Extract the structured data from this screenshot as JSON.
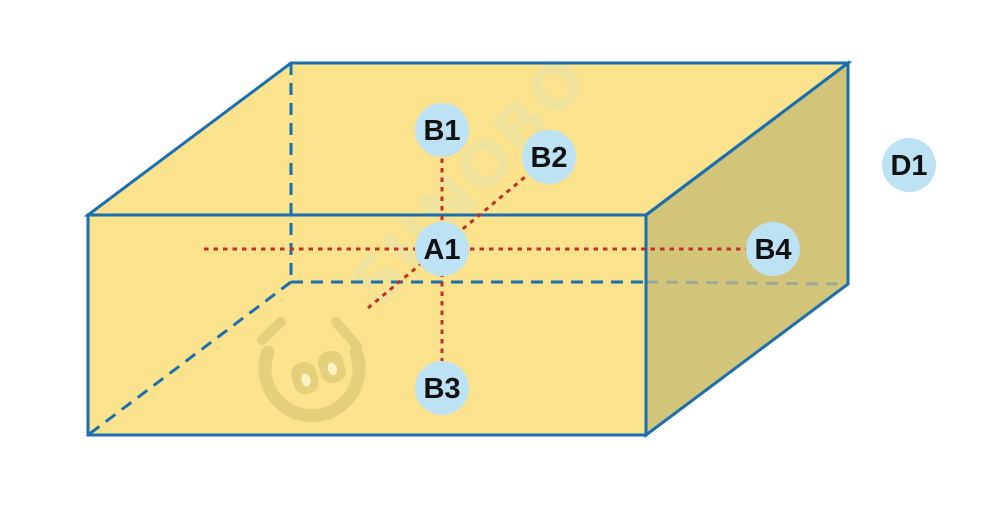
{
  "diagram": {
    "watermark": {
      "brand_text": "SUNOBO"
    },
    "colors": {
      "face_top": "#FBE38E",
      "face_front": "#FBE38E",
      "face_side": "#D2C57A",
      "edge": "#1A6FAE",
      "hidden_edge": "#1A6FAE",
      "hidden_edge_over_side": "#9AAA94",
      "guide_line": "#C12F28",
      "point_fill": "#BDE2F4",
      "point_text": "#111111",
      "watermark_text": "#EDE2A0",
      "watermark_logo": "#E2CF79",
      "watermark_logo_highlight": "#FCF4CC"
    },
    "points": [
      {
        "label": "A1"
      },
      {
        "label": "B1"
      },
      {
        "label": "B2"
      },
      {
        "label": "B3"
      },
      {
        "label": "B4"
      },
      {
        "label": "D1"
      }
    ]
  }
}
